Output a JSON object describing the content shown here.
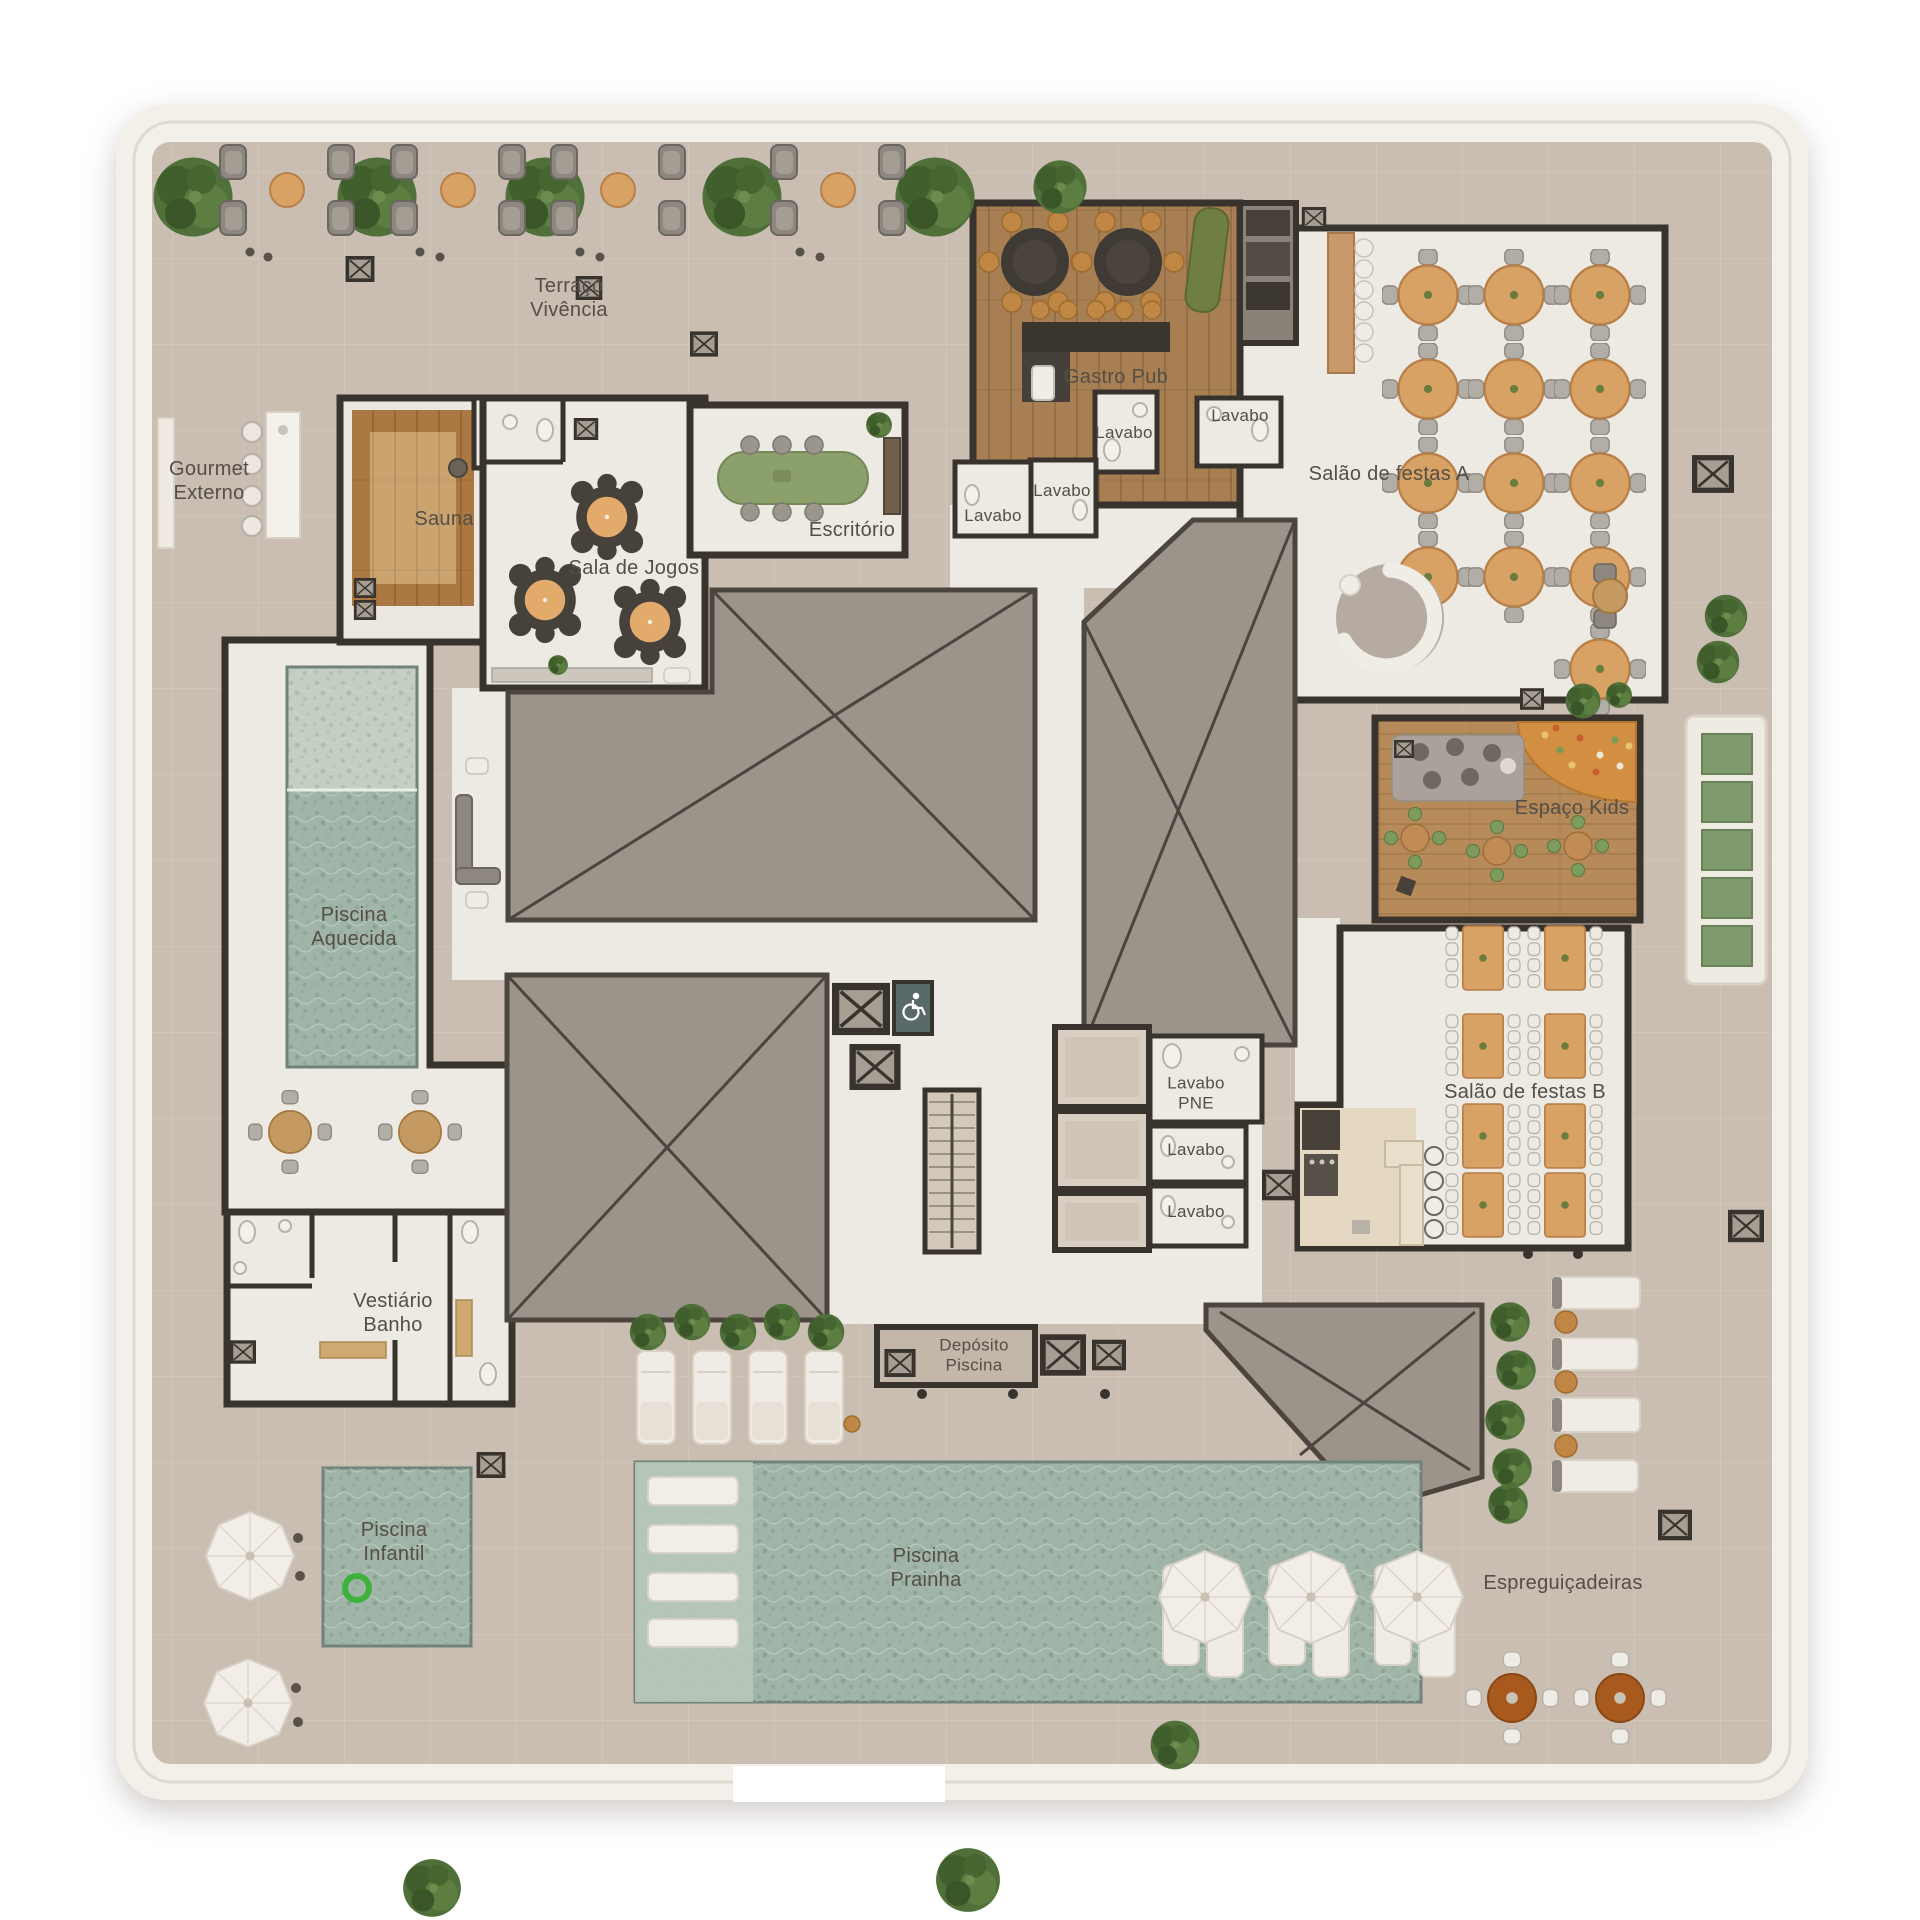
{
  "plan": {
    "language": "pt-BR",
    "view": "top-down amenities floor plan"
  },
  "palette": {
    "plate": "#f3efe9",
    "walkway": "#c9beb1",
    "floor": "#edeae3",
    "wall": "#38332d",
    "void": "#9c948b",
    "voidLine": "#4b453e",
    "pool": "#a0b5a8",
    "poolLight": "#c2cfc2",
    "woodPub": "#a87f52",
    "woodKids": "#b78a59",
    "sauna": "#aa7840",
    "tableWood": "#d7a263",
    "chairGray": "#b2ada5",
    "greenSofa": "#6f7f41",
    "hedge": "#49632f",
    "accessTeal": "#5a6a68",
    "floatRing": "#3db33d",
    "accentOrange": "#c08643",
    "brownTable": "#a85a1e",
    "labelText": "#544e46"
  },
  "labels": [
    {
      "id": "terraco-vivencia",
      "text": "Terraço\nVivência"
    },
    {
      "id": "gourmet-externo",
      "text": "Gourmet\nExterno"
    },
    {
      "id": "sauna",
      "text": "Sauna"
    },
    {
      "id": "sala-de-jogos",
      "text": "Sala de Jogos"
    },
    {
      "id": "escritorio",
      "text": "Escritório"
    },
    {
      "id": "gastro-pub",
      "text": "Gastro Pub"
    },
    {
      "id": "lavabo-1",
      "text": "Lavabo"
    },
    {
      "id": "lavabo-2",
      "text": "Lavabo"
    },
    {
      "id": "lavabo-3",
      "text": "Lavabo"
    },
    {
      "id": "lavabo-4",
      "text": "Lavabo"
    },
    {
      "id": "salao-de-festas-a",
      "text": "Salão de festas A"
    },
    {
      "id": "espaco-kids",
      "text": "Espaço Kids"
    },
    {
      "id": "piscina-aquecida",
      "text": "Piscina\nAquecida"
    },
    {
      "id": "lavabo-pne",
      "text": "Lavabo\nPNE"
    },
    {
      "id": "lavabo-5",
      "text": "Lavabo"
    },
    {
      "id": "lavabo-6",
      "text": "Lavabo"
    },
    {
      "id": "salao-de-festas-b",
      "text": "Salão de festas B"
    },
    {
      "id": "vestiario-banho",
      "text": "Vestiário\nBanho"
    },
    {
      "id": "deposito-piscina",
      "text": "Depósito\nPiscina"
    },
    {
      "id": "piscina-infantil",
      "text": "Piscina\nInfantil"
    },
    {
      "id": "piscina-prainha",
      "text": "Piscina\nPrainha"
    },
    {
      "id": "espreguicadeiras",
      "text": "Espreguiçadeiras"
    }
  ]
}
